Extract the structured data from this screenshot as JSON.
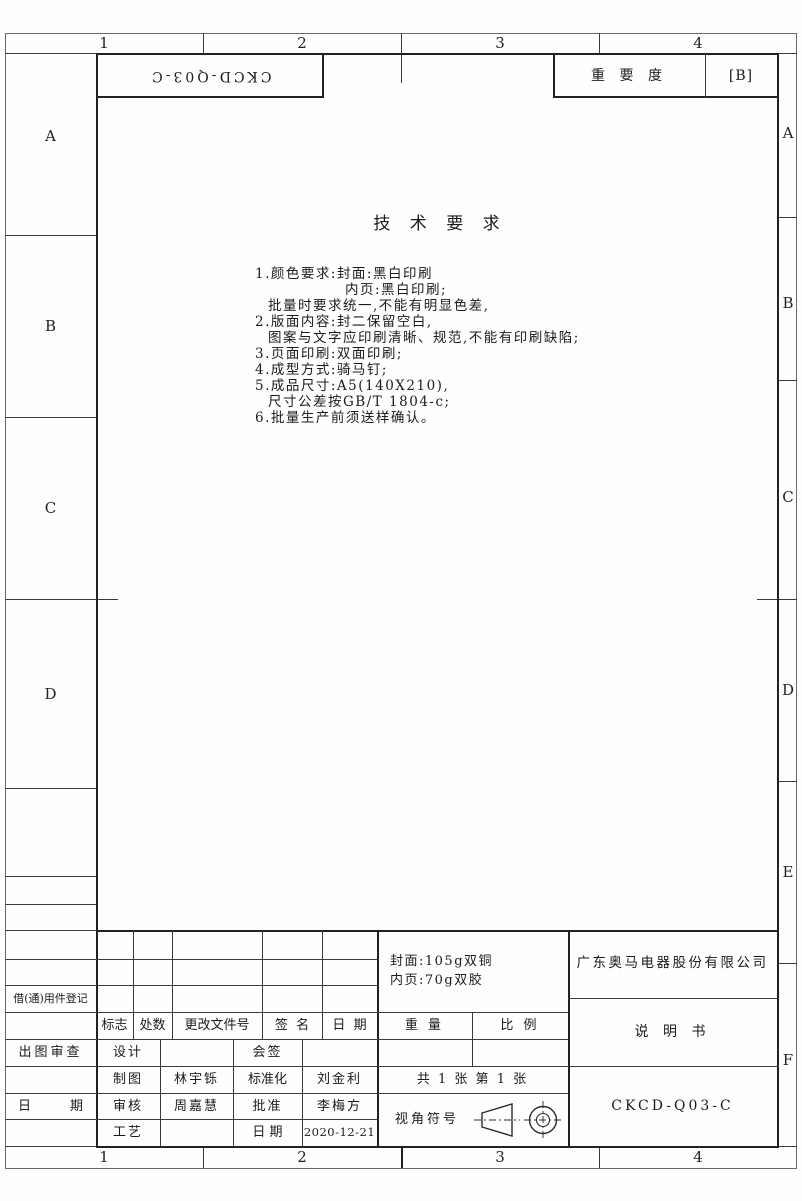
{
  "zones": {
    "top": [
      "1",
      "2",
      "3",
      "4"
    ],
    "bottom": [
      "1",
      "2",
      "3",
      "4"
    ],
    "left": [
      "A",
      "B",
      "C",
      "D"
    ],
    "right": [
      "A",
      "B",
      "C",
      "D",
      "E",
      "F"
    ]
  },
  "top_bar": {
    "rotated_code": "CKCD-Q03-C",
    "importance_label": "重 要 度",
    "importance_value": "[B]"
  },
  "tech": {
    "title": "技 术 要 求",
    "lines": [
      "1.颜色要求:封面:黑白印刷",
      "内页:黑白印刷;",
      "批量时要求统一,不能有明显色差,",
      "2.版面内容:封二保留空白,",
      "图案与文字应印刷清晰、规范,不能有印刷缺陷;",
      "3.页面印刷:双面印刷;",
      "4.成型方式:骑马钉;",
      "5.成品尺寸:A5(140X210),",
      "尺寸公差按GB/T 1804-c;",
      "6.批量生产前须送样确认。"
    ]
  },
  "revision": {
    "mark": "标志",
    "count": "处数",
    "file_no": "更改文件号",
    "signature": "签  名",
    "date": "日  期"
  },
  "block": {
    "weight": "重 量",
    "scale": "比 例",
    "paper_line1": "封面:105g双铜",
    "paper_line2": "内页:70g双胶",
    "sheets": "共 1 张 第 1 张",
    "view_label": "视角符号",
    "company": "广东奥马电器股份有限公司",
    "doc_title": "说 明 书",
    "doc_code": "CKCD-Q03-C",
    "design": "设计",
    "countersign": "会签",
    "draft": "制图",
    "draft_name": "林宇铄",
    "standard": "标准化",
    "standard_name": "刘金利",
    "check": "审核",
    "check_name": "周嘉慧",
    "approve": "批准",
    "approve_name": "李梅方",
    "process": "工艺",
    "date_label": "日 期",
    "date_value": "2020-12-21"
  },
  "margin": {
    "borrow": "借(通)用件登记",
    "review": "出图审查",
    "date_spread": "日　　　期"
  }
}
